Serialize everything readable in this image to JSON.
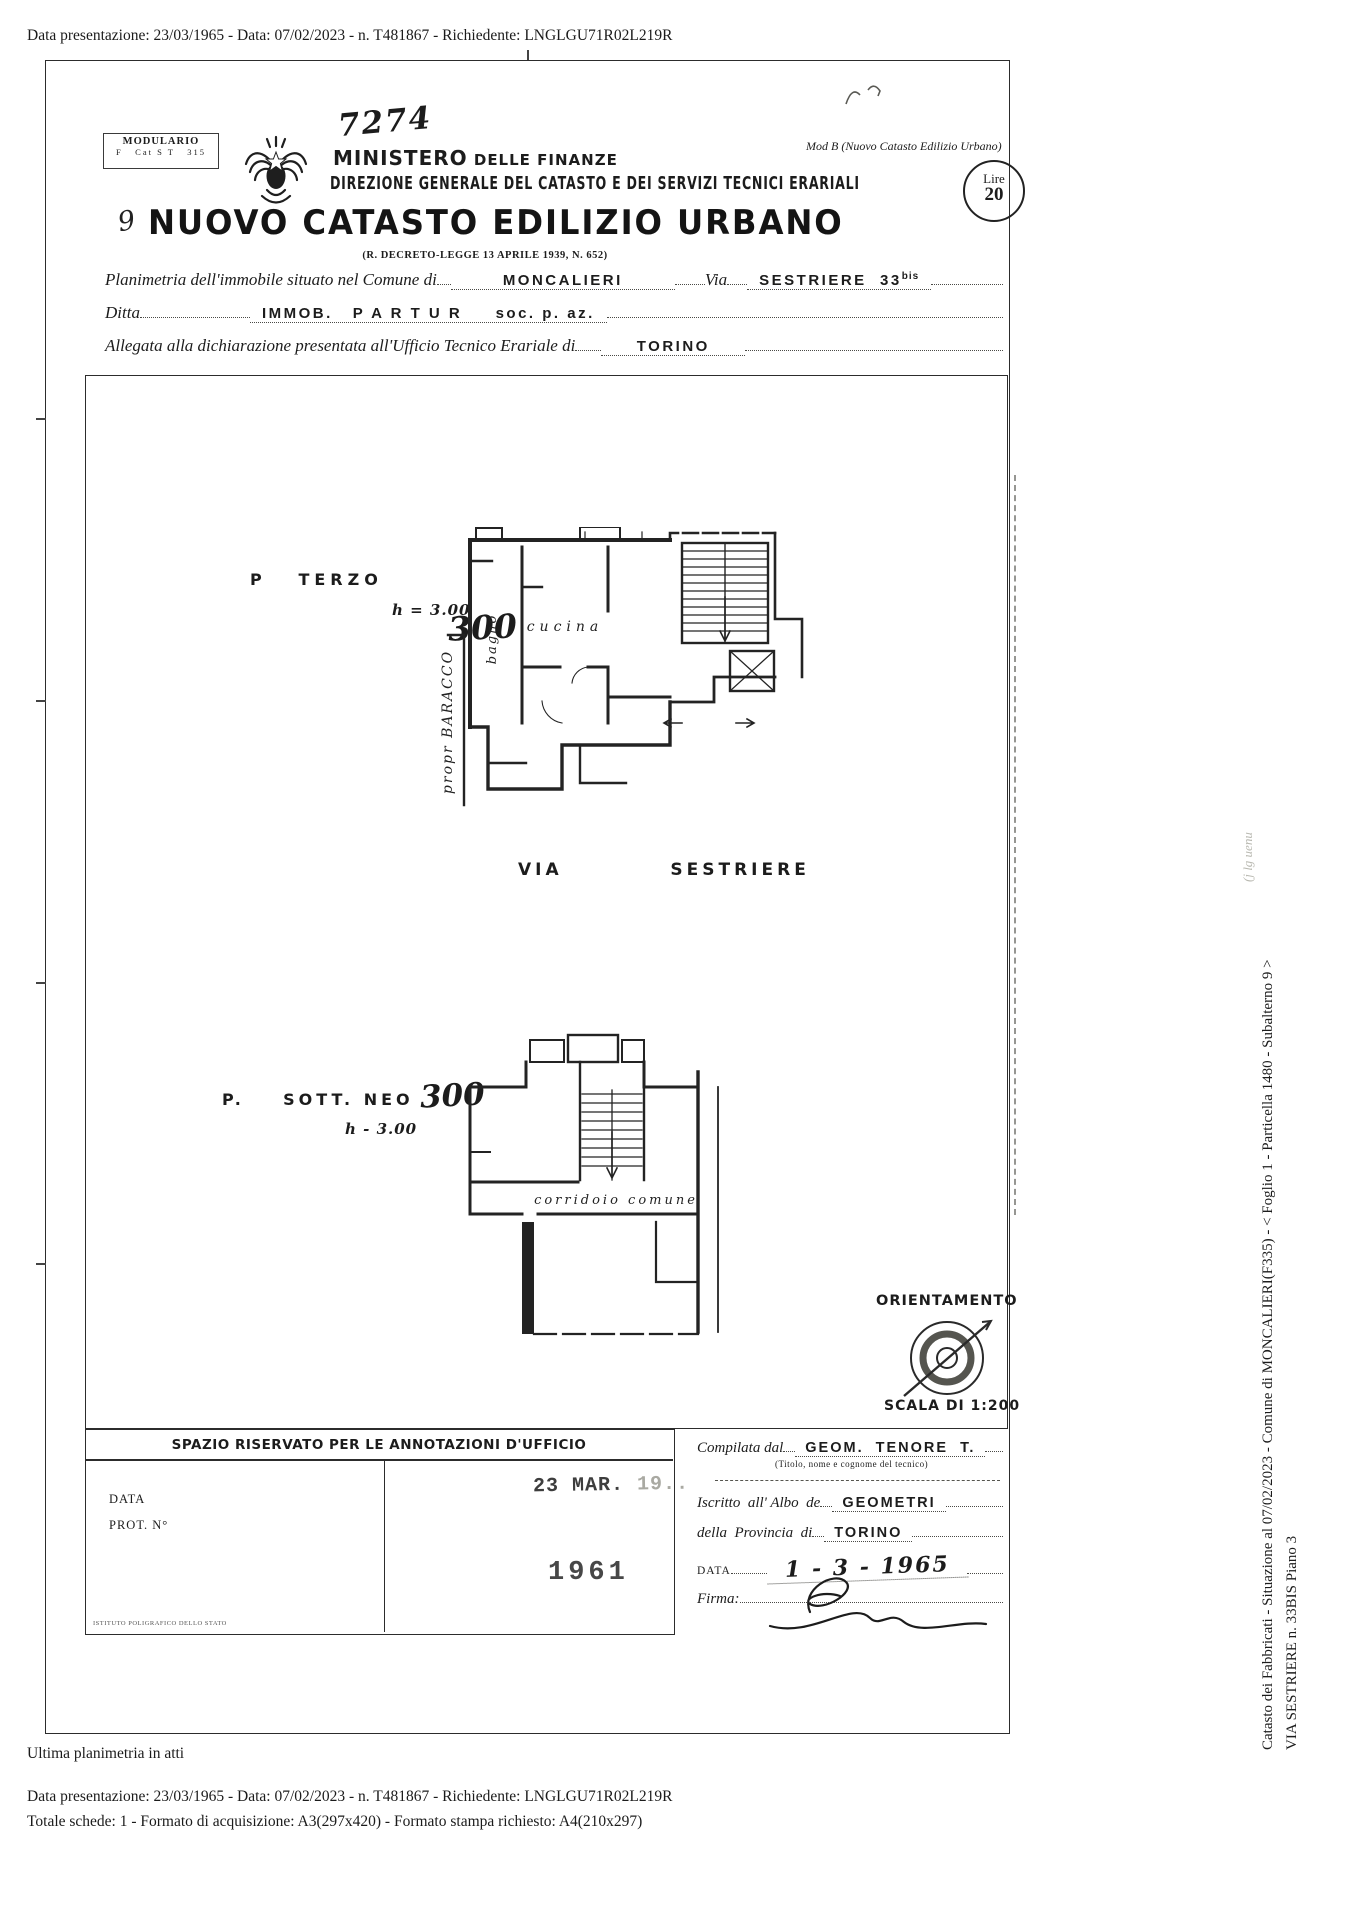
{
  "colors": {
    "ink": "#1c1c1c",
    "paper": "#ffffff",
    "faint": "#b9b9b1",
    "stamp": "#474747"
  },
  "top_bar": {
    "text": "Data presentazione: 23/03/1965 - Data: 07/02/2023 - n. T481867 - Richiedente: LNGLGU71R02L219R"
  },
  "header": {
    "modulario_title": "MODULARIO",
    "modulario_code": "F   Cat S T   315",
    "hand_number": "7274",
    "ministero": "MINISTERO",
    "ministero_sub": " DELLE FINANZE",
    "direzione": "DIREZIONE GENERALE DEL CATASTO E DEI SERVIZI TECNICI ERARIALI",
    "mod_b": "Mod  B (Nuovo Catasto Edilizio Urbano)",
    "lire_label": "Lire",
    "lire_value": "20",
    "title_script": "9",
    "title": "NUOVO CATASTO EDILIZIO URBANO",
    "decreto": "(R. DECRETO-LEGGE 13 APRILE 1939, N. 652)"
  },
  "form": {
    "planimetria_label": "Planimetria dell'immobile situato nel Comune di",
    "comune": "MONCALIERI",
    "via_label": "Via",
    "via_value": "SESTRIERE  33",
    "via_sup": "bis",
    "ditta_label": "Ditta",
    "ditta_value": "IMMOB.   P A R T U R     soc. p. az.",
    "allegata_label": "Allegata alla dichiarazione presentata all'Ufficio Tecnico Erariale di",
    "ufficio": "TORINO"
  },
  "plan1": {
    "label": "P   TERZO",
    "height": "h = 3.00",
    "hand": "300",
    "bagno": "bagno",
    "cucina": "cucina",
    "propr": "propr  BARACCO",
    "via": "VIA   SESTRIERE"
  },
  "plan2": {
    "label": "P.    SOTT. NEO",
    "hand": "300",
    "height": "h - 3.00",
    "corridoio": "corridoio  comune"
  },
  "orientation": {
    "label": "ORIENTAMENTO",
    "scala": "SCALA DI 1:200"
  },
  "annotations": {
    "header": "SPAZIO RISERVATO PER LE ANNOTAZIONI D'UFFICIO",
    "data_label": "DATA",
    "prot_label": "PROT. N°",
    "stamp_date": "23 MAR.",
    "stamp_date_faint": " 19..",
    "stamp_year": "1961",
    "tiny": "ISTITUTO POLIGRAFICO DELLO STATO"
  },
  "compiler": {
    "compilata_label": "Compilata dal",
    "compilata_value": "GEOM.  TENORE  T.",
    "titolo_note": "(Titolo, nome e cognome del tecnico)",
    "iscritto_label": "Iscritto  all' Albo  de",
    "iscritto_value": "GEOMETRI",
    "provincia_label": "della  Provincia  di",
    "provincia_value": "TORINO",
    "data_label": "DATA",
    "data_value": "1 - 3 - 1965",
    "firma_label": "Firma:"
  },
  "side": {
    "catasto_line": "Catasto dei Fabbricati - Situazione al 07/02/2023 - Comune di MONCALIERI(F335) - < Foglio 1 - Particella 1480 - Subalterno 9 >",
    "via_line": "VIA SESTRIERE n. 33BIS Piano 3",
    "faint": "(j lg uenu"
  },
  "footer": {
    "ultima": "Ultima planimetria in atti",
    "line1": "Data presentazione: 23/03/1965 - Data: 07/02/2023 - n. T481867 - Richiedente: LNGLGU71R02L219R",
    "line2": "Totale schede: 1 - Formato di acquisizione: A3(297x420)  - Formato stampa richiesto: A4(210x297)"
  }
}
